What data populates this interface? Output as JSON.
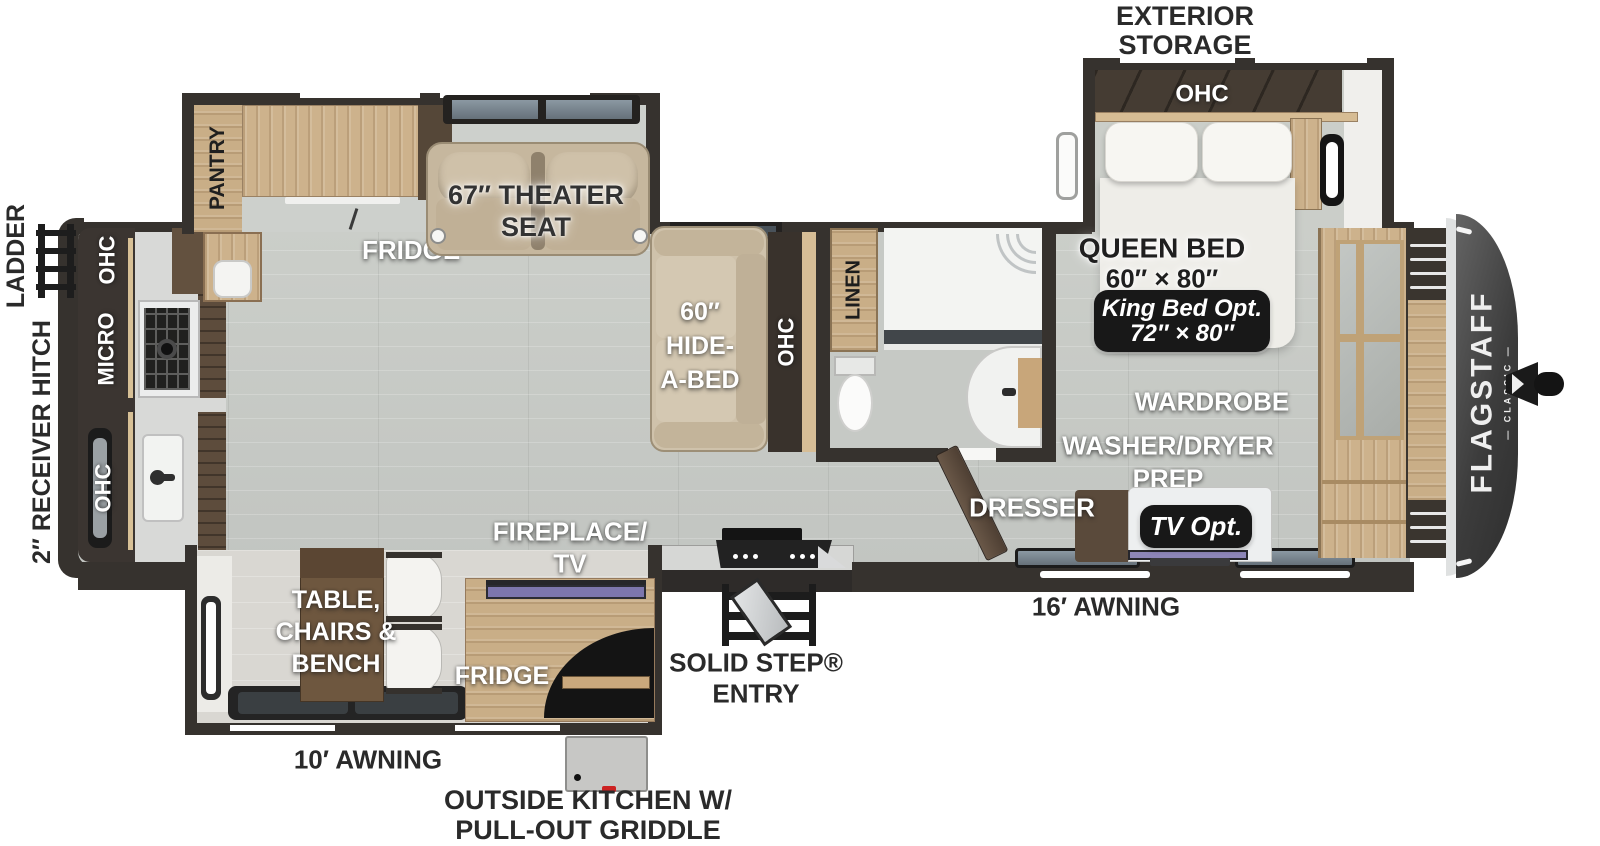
{
  "colors": {
    "floor": "#c8cbc7",
    "wall": "#36322e",
    "wood_light": "#cdb28c",
    "wood_dark": "#5d4c3c",
    "label_white": "#ffffff",
    "label_black": "#2a2a2a",
    "badge_bg": "#181818",
    "tv_accent": "#7d76ad",
    "front_cap": "#3c3c3c"
  },
  "brand": {
    "name": "FLAGSTAFF",
    "series": "— CLASSIC —"
  },
  "exterior": {
    "exterior_storage_l1": "EXTERIOR",
    "exterior_storage_l2": "STORAGE",
    "ladder": "LADDER",
    "hitch": "2″ RECEIVER HITCH",
    "awning16": "16′ AWNING",
    "awning10": "10′ AWNING",
    "entry_l1": "SOLID STEP®",
    "entry_l2": "ENTRY",
    "outside_kitchen_l1": "OUTSIDE KITCHEN W/",
    "outside_kitchen_l2": "PULL-OUT GRIDDLE"
  },
  "bedroom": {
    "ohc": "OHC",
    "queen_l1": "QUEEN BED",
    "queen_l2": "60″ × 80″",
    "king_l1": "King Bed Opt.",
    "king_l2": "72″ × 80″",
    "wardrobe": "WARDROBE",
    "washer_dryer_l1": "WASHER/DRYER",
    "washer_dryer_l2": "PREP",
    "dresser": "DRESSER",
    "tv_opt": "TV Opt."
  },
  "bathroom": {
    "linen": "LINEN"
  },
  "living": {
    "hide_a_bed_l1": "60″",
    "hide_a_bed_l2": "HIDE-",
    "hide_a_bed_l3": "A-BED",
    "sofa_ohc": "OHC",
    "theater_l1": "67″ THEATER",
    "theater_l2": "SEAT",
    "fridge": "FRIDGE",
    "pantry": "PANTRY"
  },
  "kitchen": {
    "ohc_rear": "OHC",
    "micro": "MICRO",
    "ohc_sink": "OHC"
  },
  "dinette": {
    "table_l1": "TABLE,",
    "table_l2": "CHAIRS &",
    "table_l3": "BENCH",
    "fireplace_l1": "FIREPLACE/",
    "fireplace_l2": "TV",
    "fridge": "FRIDGE"
  }
}
